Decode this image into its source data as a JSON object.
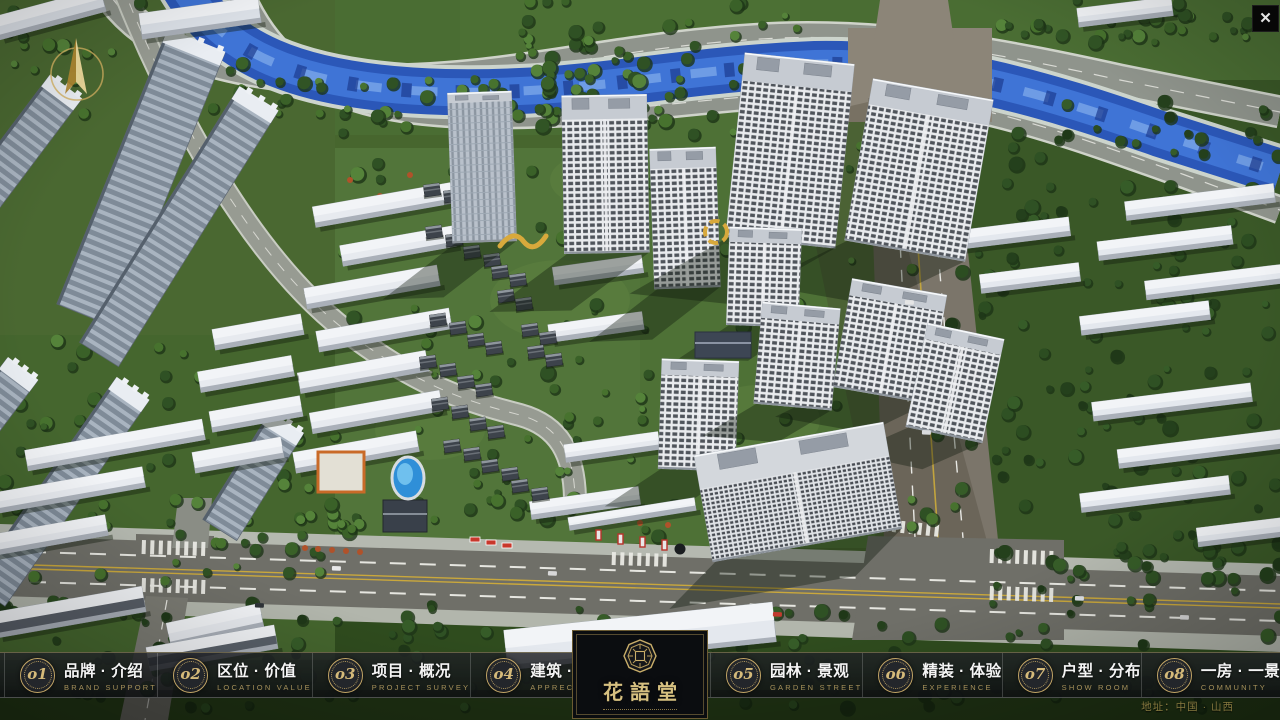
{
  "window": {
    "close_label": "✕"
  },
  "menu": {
    "items": [
      {
        "num": "o1",
        "zh": "品牌 · 介绍",
        "en": "BRAND SUPPORT"
      },
      {
        "num": "o2",
        "zh": "区位 · 价值",
        "en": "LOCATION VALUE"
      },
      {
        "num": "o3",
        "zh": "项目 · 概况",
        "en": "PROJECT SURVEY"
      },
      {
        "num": "o4",
        "zh": "建筑 · 鉴赏",
        "en": "APPRECIATION"
      },
      {
        "num": "o5",
        "zh": "园林 · 景观",
        "en": "GARDEN STREET"
      },
      {
        "num": "o6",
        "zh": "精装 · 体验",
        "en": "EXPERIENCE"
      },
      {
        "num": "o7",
        "zh": "户型 · 分布",
        "en": "SHOW ROOM"
      },
      {
        "num": "o8",
        "zh": "一房 · 一景",
        "en": "COMMUNITY"
      }
    ]
  },
  "logo": {
    "title": "花語堂"
  },
  "footer": {
    "address": "地址：中国 · 山西"
  },
  "colors": {
    "gold": "#c7ab66",
    "bar_bg": "#15171b",
    "river": "#2b57b8",
    "grass": "#47662e"
  }
}
